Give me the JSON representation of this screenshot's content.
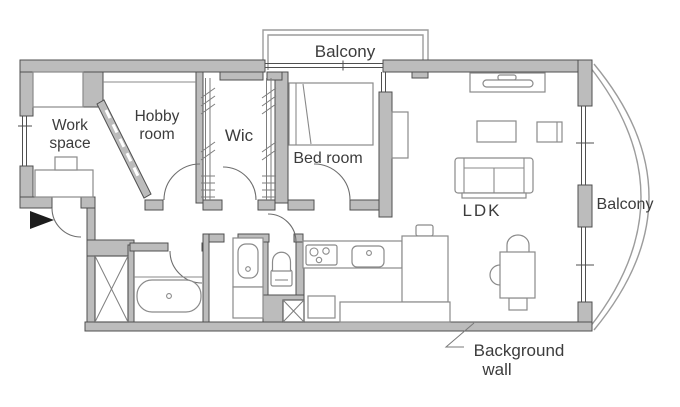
{
  "figure": {
    "kind": "apartment-floor-plan",
    "width_px": 680,
    "height_px": 407
  },
  "colors": {
    "wall_fill": "#bcbcbc",
    "wall_stroke": "#4f4f4f",
    "furniture_stroke": "#8a8a8a",
    "door_stroke": "#6e6e6e",
    "balcony_stroke": "#9c9c9c",
    "label_color": "#3c3c3c",
    "entrance_marker": "#1d1d1d",
    "background": "#ffffff"
  },
  "rooms": {
    "balcony_top": {
      "label": "Balcony"
    },
    "work_space": {
      "line1": "Work",
      "line2": "space"
    },
    "hobby_room": {
      "line1": "Hobby",
      "line2": "room"
    },
    "wic": {
      "label": "Wic"
    },
    "bed_room": {
      "label": "Bed room"
    },
    "ldk": {
      "label": "LDK"
    },
    "balcony_right": {
      "label": "Balcony"
    }
  },
  "annotations": {
    "background_wall": {
      "line1": "Background",
      "line2": "wall"
    }
  }
}
